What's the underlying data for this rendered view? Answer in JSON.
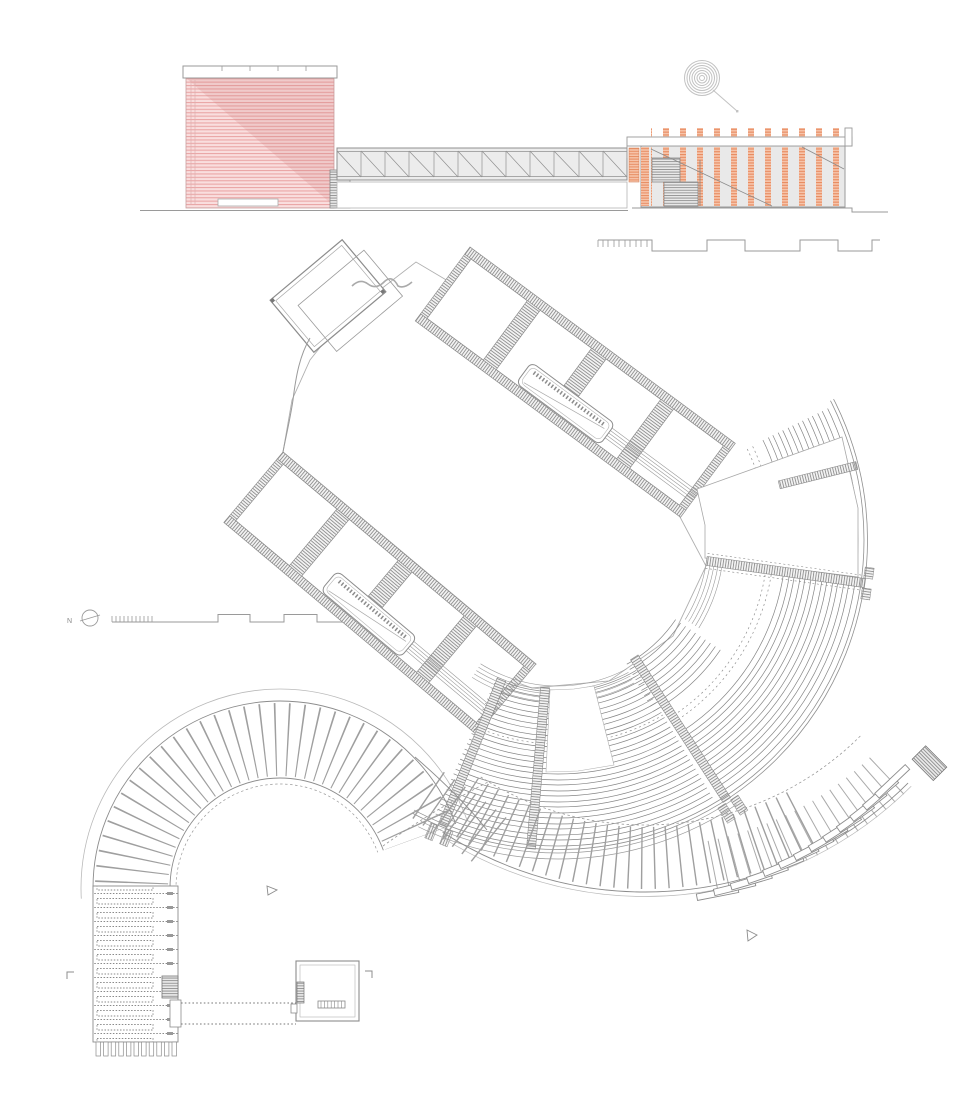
{
  "document": {
    "kind": "architectural drawing sheet (plan, elevation, promenade)",
    "north_label": "N",
    "palette": {
      "paper": "#ffffff",
      "pink_fill": "#f9dede",
      "pink_line": "#e8a3a3",
      "pink_shade": "rgba(205,125,125,0.20)",
      "orange_fill": "#f6c4aa",
      "orange_line": "#e78b60",
      "gray_fill": "#e9e9e9",
      "line_dark": "#8c8c8c",
      "line_light": "#b9b9b9"
    },
    "figures": {
      "elevation": "section-elevation: louvered pink pavilion, truss footbridge, striped long hall",
      "plan": "amphitheatre plan: entry pavilion, two room wings with stairs, stage, tiered seating bowl",
      "promenade": "curved plank boardwalk with radial treads, stair cascade and straight tail",
      "kiosk": "small square pavilion plan linked by dotted guide lines",
      "symbols": [
        "north indicator",
        "stepped scale bar left",
        "stepped scale bar top",
        "concentric rings marker"
      ]
    }
  }
}
